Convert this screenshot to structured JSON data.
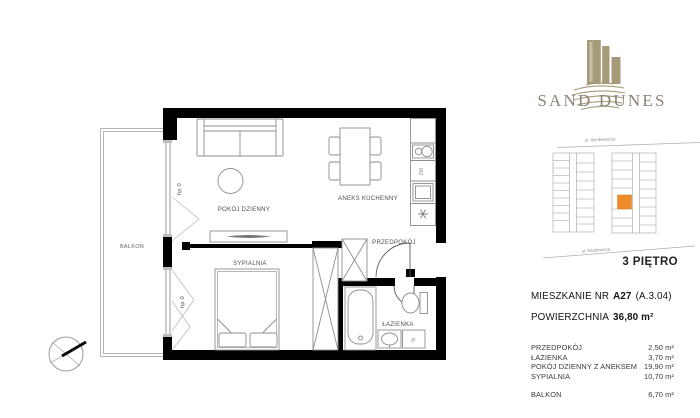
{
  "branding": {
    "name": "SAND DUNES",
    "logo_color": "#a69b79",
    "text_color": "#8b8376"
  },
  "locator": {
    "street_top": "ul. Sienkiewicza",
    "street_bottom": "ul. Mickiewicza",
    "floor_label": "3 PIĘTRO",
    "highlight_color": "#ef8a2d"
  },
  "unit": {
    "title_prefix": "MIESZKANIE NR",
    "number": "A27",
    "code": "(A.3.04)",
    "area_label": "POWIERZCHNIA",
    "area_value": "36,80 m²"
  },
  "rooms": [
    {
      "label": "PRZEDPOKÓJ",
      "area": "2,50 m²"
    },
    {
      "label": "ŁAZIENKA",
      "area": "3,70 m²"
    },
    {
      "label": "POKÓJ DZIENNY Z ANEKSEM",
      "area": "19,90 m²"
    },
    {
      "label": "SYPIALNIA",
      "area": "10,70 m²"
    }
  ],
  "balcony_row": {
    "label": "BALKON",
    "area": "6,70 m²"
  },
  "plan": {
    "wall_color": "#000000",
    "labels": {
      "living": "POKÓJ DZIENNY",
      "kitchen": "ANEKS KUCHENNY",
      "hall": "PRZEDPOKÓJ",
      "bedroom": "SYPIALNIA",
      "bath": "ŁAZIENKA",
      "balcony": "BALKON",
      "sill_living": "hp 0",
      "sill_bedroom": "hp 0",
      "dishwasher": "ZM",
      "washer": "P"
    }
  }
}
